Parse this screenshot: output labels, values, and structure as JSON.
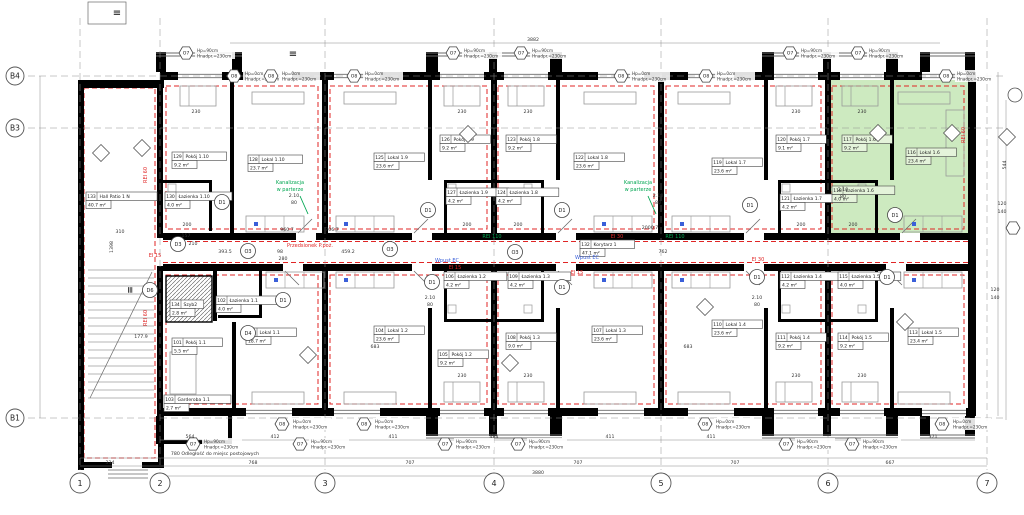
{
  "colors": {
    "wall": "#000000",
    "thin": "#6a6a6a",
    "red_line": "#e02525",
    "green_note": "#00a651",
    "blue_note": "#3a5fd9",
    "unit_highlight": "#cdeac0",
    "dim_text": "#333333",
    "grid": "#909090"
  },
  "grid": {
    "columns": [
      {
        "label": "1",
        "x": 80
      },
      {
        "label": "2",
        "x": 160
      },
      {
        "label": "3",
        "x": 325
      },
      {
        "label": "4",
        "x": 494
      },
      {
        "label": "5",
        "x": 661
      },
      {
        "label": "6",
        "x": 828
      },
      {
        "label": "7",
        "x": 987
      }
    ],
    "rows": [
      {
        "label": "B4",
        "y": 76
      },
      {
        "label": "B3",
        "y": 128
      },
      {
        "label": "B1",
        "y": 418
      }
    ]
  },
  "marker_legend": {
    "O7": [
      "Hp=90cm",
      "Hnadpr.=230cm"
    ],
    "O8": [
      "Hp=0cm",
      "Hnadpr.=230cm"
    ]
  },
  "window_markers": [
    {
      "type": "O7",
      "x": 186,
      "y": 53
    },
    {
      "type": "O7",
      "x": 453,
      "y": 53
    },
    {
      "type": "O7",
      "x": 521,
      "y": 53
    },
    {
      "type": "O7",
      "x": 790,
      "y": 53
    },
    {
      "type": "O7",
      "x": 858,
      "y": 53
    },
    {
      "type": "O8",
      "x": 234,
      "y": 76
    },
    {
      "type": "O8",
      "x": 271,
      "y": 76
    },
    {
      "type": "O8",
      "x": 354,
      "y": 76
    },
    {
      "type": "O8",
      "x": 621,
      "y": 76
    },
    {
      "type": "O8",
      "x": 706,
      "y": 76
    },
    {
      "type": "O8",
      "x": 946,
      "y": 76
    },
    {
      "type": "O8",
      "x": 282,
      "y": 424
    },
    {
      "type": "O8",
      "x": 364,
      "y": 424
    },
    {
      "type": "O8",
      "x": 705,
      "y": 424
    },
    {
      "type": "O8",
      "x": 942,
      "y": 424
    },
    {
      "type": "O7",
      "x": 193,
      "y": 444
    },
    {
      "type": "O7",
      "x": 300,
      "y": 444
    },
    {
      "type": "O7",
      "x": 445,
      "y": 444
    },
    {
      "type": "O7",
      "x": 518,
      "y": 444
    },
    {
      "type": "O7",
      "x": 786,
      "y": 444
    },
    {
      "type": "O7",
      "x": 852,
      "y": 444
    }
  ],
  "rooms": [
    {
      "num": "129",
      "name": "Pokój 1.10",
      "area": "9.2 m²",
      "x": 172,
      "y": 152
    },
    {
      "num": "128",
      "name": "Lokal 1.10",
      "area": "23.7 m²",
      "x": 248,
      "y": 155
    },
    {
      "num": "130",
      "name": "Łazienka 1.10",
      "area": "4.0 m²",
      "x": 165,
      "y": 192
    },
    {
      "num": "125",
      "name": "Lokal 1.9",
      "area": "23.6 m²",
      "x": 374,
      "y": 153
    },
    {
      "num": "126",
      "name": "Pokój 1.9",
      "area": "9.2 m²",
      "x": 440,
      "y": 135
    },
    {
      "num": "127",
      "name": "Łazienka 1.9",
      "area": "4.2 m²",
      "x": 446,
      "y": 188
    },
    {
      "num": "122",
      "name": "Lokal 1.8",
      "area": "23.6 m²",
      "x": 574,
      "y": 153
    },
    {
      "num": "123",
      "name": "Pokój 1.8",
      "area": "9.2 m²",
      "x": 506,
      "y": 135
    },
    {
      "num": "124",
      "name": "Łazienka 1.8",
      "area": "4.2 m²",
      "x": 496,
      "y": 188
    },
    {
      "num": "119",
      "name": "Lokal 1.7",
      "area": "23.6 m²",
      "x": 712,
      "y": 158
    },
    {
      "num": "120",
      "name": "Pokój 1.7",
      "area": "9.1 m²",
      "x": 776,
      "y": 135
    },
    {
      "num": "121",
      "name": "Łazienka 1.7",
      "area": "4.2 m²",
      "x": 780,
      "y": 194
    },
    {
      "num": "116",
      "name": "Lokal 1.6",
      "area": "23.4 m²",
      "x": 906,
      "y": 148,
      "green": true
    },
    {
      "num": "117",
      "name": "Pokój 1.6",
      "area": "9.2 m²",
      "x": 842,
      "y": 135,
      "green": true
    },
    {
      "num": "118",
      "name": "Łazienka 1.6",
      "area": "4.0 m²",
      "x": 832,
      "y": 186,
      "green": true
    },
    {
      "num": "133",
      "name": "Hall Patio 1 N",
      "area": "40.7 m²",
      "x": 86,
      "y": 192
    },
    {
      "num": "132",
      "name": "Korytarz 1",
      "area": "47.1 m²",
      "x": 580,
      "y": 240
    },
    {
      "num": "134",
      "name": "Szyb2",
      "area": "2.8 m²",
      "x": 170,
      "y": 300
    },
    {
      "num": "102",
      "name": "Łazienka 1.1",
      "area": "4.0 m²",
      "x": 216,
      "y": 296
    },
    {
      "num": "101",
      "name": "Pokój 1.1",
      "area": "5.5 m²",
      "x": 172,
      "y": 338
    },
    {
      "num": "100",
      "name": "Lokal 1.1",
      "area": "18.7 m²",
      "x": 246,
      "y": 328
    },
    {
      "num": "103",
      "name": "Garderoba 1.1",
      "area": "2.7 m²",
      "x": 164,
      "y": 395
    },
    {
      "num": "104",
      "name": "Lokal 1.2",
      "area": "23.6 m²",
      "x": 374,
      "y": 326
    },
    {
      "num": "105",
      "name": "Pokój 1.2",
      "area": "9.2 m²",
      "x": 438,
      "y": 350
    },
    {
      "num": "106",
      "name": "Łazienka 1.2",
      "area": "4.2 m²",
      "x": 444,
      "y": 272
    },
    {
      "num": "107",
      "name": "Lokal 1.3",
      "area": "23.6 m²",
      "x": 592,
      "y": 326
    },
    {
      "num": "108",
      "name": "Pokój 1.3",
      "area": "9.0 m²",
      "x": 506,
      "y": 333
    },
    {
      "num": "109",
      "name": "Łazienka 1.3",
      "area": "4.2 m²",
      "x": 508,
      "y": 272
    },
    {
      "num": "110",
      "name": "Lokal 1.4",
      "area": "23.6 m²",
      "x": 712,
      "y": 320
    },
    {
      "num": "111",
      "name": "Pokój 1.4",
      "area": "9.2 m²",
      "x": 776,
      "y": 333
    },
    {
      "num": "112",
      "name": "Łazienka 1.4",
      "area": "4.2 m²",
      "x": 780,
      "y": 272
    },
    {
      "num": "113",
      "name": "Lokal 1.5",
      "area": "23.4 m²",
      "x": 908,
      "y": 328
    },
    {
      "num": "114",
      "name": "Pokój 1.5",
      "area": "9.2 m²",
      "x": 838,
      "y": 333
    },
    {
      "num": "115",
      "name": "Łazienka 1.5",
      "area": "4.0 m²",
      "x": 838,
      "y": 272
    }
  ],
  "door_markers": [
    {
      "label": "D1",
      "x": 222,
      "y": 202
    },
    {
      "label": "D1",
      "x": 428,
      "y": 210
    },
    {
      "label": "D1",
      "x": 562,
      "y": 210
    },
    {
      "label": "D1",
      "x": 750,
      "y": 205
    },
    {
      "label": "D1",
      "x": 895,
      "y": 215
    },
    {
      "label": "D1",
      "x": 283,
      "y": 300
    },
    {
      "label": "D1",
      "x": 432,
      "y": 282
    },
    {
      "label": "D1",
      "x": 562,
      "y": 287
    },
    {
      "label": "D1",
      "x": 757,
      "y": 277
    },
    {
      "label": "D1",
      "x": 887,
      "y": 277
    },
    {
      "label": "D4",
      "x": 248,
      "y": 333
    },
    {
      "label": "D6",
      "x": 150,
      "y": 290
    },
    {
      "label": "D3",
      "x": 178,
      "y": 244
    },
    {
      "label": "O3",
      "x": 248,
      "y": 251
    },
    {
      "label": "O3",
      "x": 515,
      "y": 252
    },
    {
      "label": "O3",
      "x": 390,
      "y": 249
    }
  ],
  "diamonds": [
    {
      "x": 101,
      "y": 153
    },
    {
      "x": 142,
      "y": 148
    },
    {
      "x": 468,
      "y": 134
    },
    {
      "x": 878,
      "y": 133
    },
    {
      "x": 952,
      "y": 133
    },
    {
      "x": 510,
      "y": 363
    },
    {
      "x": 705,
      "y": 307
    },
    {
      "x": 905,
      "y": 322
    },
    {
      "x": 308,
      "y": 355
    },
    {
      "x": 1007,
      "y": 137
    }
  ],
  "dimensions": [
    {
      "x": 110,
      "y": 464,
      "t": "334"
    },
    {
      "x": 253,
      "y": 464,
      "t": "768"
    },
    {
      "x": 410,
      "y": 464,
      "t": "707"
    },
    {
      "x": 578,
      "y": 464,
      "t": "707"
    },
    {
      "x": 735,
      "y": 464,
      "t": "707"
    },
    {
      "x": 890,
      "y": 464,
      "t": "667"
    },
    {
      "x": 215,
      "y": 455,
      "t": "780  Odległość do miejsc postojowych"
    },
    {
      "x": 538,
      "y": 474,
      "t": "3880"
    },
    {
      "x": 533,
      "y": 41,
      "t": "3882"
    },
    {
      "x": 190,
      "y": 438,
      "t": "564"
    },
    {
      "x": 275,
      "y": 438,
      "t": "412"
    },
    {
      "x": 393,
      "y": 438,
      "t": "411"
    },
    {
      "x": 494,
      "y": 438,
      "t": "484"
    },
    {
      "x": 610,
      "y": 438,
      "t": "411"
    },
    {
      "x": 711,
      "y": 438,
      "t": "411"
    },
    {
      "x": 933,
      "y": 438,
      "t": "371"
    },
    {
      "x": 287,
      "y": 231,
      "t": "960.7"
    },
    {
      "x": 332,
      "y": 231,
      "t": "706.7"
    },
    {
      "x": 650,
      "y": 229,
      "t": "2000.7"
    },
    {
      "x": 663,
      "y": 253,
      "t": "762"
    },
    {
      "x": 225,
      "y": 253,
      "t": "393.5"
    },
    {
      "x": 280,
      "y": 253,
      "t": "98"
    },
    {
      "x": 283,
      "y": 260,
      "t": "280"
    },
    {
      "x": 348,
      "y": 253,
      "t": "459.2"
    },
    {
      "x": 186,
      "y": 237,
      "t": "157"
    },
    {
      "x": 193,
      "y": 245,
      "t": "210"
    },
    {
      "x": 196,
      "y": 113,
      "t": "230"
    },
    {
      "x": 462,
      "y": 113,
      "t": "230"
    },
    {
      "x": 528,
      "y": 113,
      "t": "230"
    },
    {
      "x": 796,
      "y": 113,
      "t": "230"
    },
    {
      "x": 862,
      "y": 113,
      "t": "230"
    },
    {
      "x": 462,
      "y": 377,
      "t": "230"
    },
    {
      "x": 528,
      "y": 377,
      "t": "230"
    },
    {
      "x": 796,
      "y": 377,
      "t": "230"
    },
    {
      "x": 862,
      "y": 377,
      "t": "230"
    },
    {
      "x": 187,
      "y": 226,
      "t": "200"
    },
    {
      "x": 467,
      "y": 226,
      "t": "200"
    },
    {
      "x": 518,
      "y": 226,
      "t": "200"
    },
    {
      "x": 801,
      "y": 226,
      "t": "200"
    },
    {
      "x": 853,
      "y": 226,
      "t": "200"
    },
    {
      "x": 375,
      "y": 348,
      "t": "683"
    },
    {
      "x": 688,
      "y": 348,
      "t": "683"
    },
    {
      "x": 294,
      "y": 197,
      "t": "2.10"
    },
    {
      "x": 294,
      "y": 204,
      "t": "80"
    },
    {
      "x": 658,
      "y": 197,
      "t": "2.10"
    },
    {
      "x": 658,
      "y": 204,
      "t": "80"
    },
    {
      "x": 843,
      "y": 191,
      "t": "2.10"
    },
    {
      "x": 843,
      "y": 198,
      "t": "80"
    },
    {
      "x": 430,
      "y": 299,
      "t": "2.10"
    },
    {
      "x": 430,
      "y": 306,
      "t": "80"
    },
    {
      "x": 757,
      "y": 299,
      "t": "2.10"
    },
    {
      "x": 757,
      "y": 306,
      "t": "80"
    },
    {
      "x": 1002,
      "y": 205,
      "t": "120"
    },
    {
      "x": 1002,
      "y": 213,
      "t": "140"
    },
    {
      "x": 995,
      "y": 291,
      "t": "120"
    },
    {
      "x": 995,
      "y": 299,
      "t": "140"
    },
    {
      "x": 1006,
      "y": 165,
      "t": "544",
      "r": -90
    },
    {
      "x": 113,
      "y": 247,
      "t": "1398",
      "r": -90
    },
    {
      "x": 120,
      "y": 233,
      "t": "310"
    },
    {
      "x": 141,
      "y": 338,
      "t": "177.9"
    }
  ],
  "annotations": [
    {
      "x": 310,
      "y": 247,
      "t": "Przedsionek P.poż.",
      "c": "red"
    },
    {
      "x": 617,
      "y": 238,
      "t": "EI 30",
      "c": "red"
    },
    {
      "x": 758,
      "y": 261,
      "t": "EI 30",
      "c": "red"
    },
    {
      "x": 155,
      "y": 257,
      "t": "EI 15",
      "c": "red"
    },
    {
      "x": 455,
      "y": 269,
      "t": "EI 15",
      "c": "red"
    },
    {
      "x": 577,
      "y": 274,
      "t": "EI 15",
      "c": "red"
    },
    {
      "x": 147,
      "y": 175,
      "t": "REI 60",
      "c": "red",
      "r": -90
    },
    {
      "x": 147,
      "y": 318,
      "t": "REI 60",
      "c": "red",
      "r": -90
    },
    {
      "x": 965,
      "y": 135,
      "t": "REI 60",
      "c": "red",
      "r": -90
    },
    {
      "x": 290,
      "y": 184,
      "t": "Kanalizacja",
      "c": "green"
    },
    {
      "x": 290,
      "y": 191,
      "t": "w parterze",
      "c": "green"
    },
    {
      "x": 638,
      "y": 184,
      "t": "Kanalizacja",
      "c": "green"
    },
    {
      "x": 638,
      "y": 191,
      "t": "w parterze",
      "c": "green"
    },
    {
      "x": 492,
      "y": 238,
      "t": "REI 110",
      "c": "green"
    },
    {
      "x": 675,
      "y": 238,
      "t": "REI 110",
      "c": "green"
    },
    {
      "x": 447,
      "y": 262,
      "t": "Wpust EC",
      "c": "blue"
    },
    {
      "x": 587,
      "y": 259,
      "t": "Wpust EC",
      "c": "blue"
    },
    {
      "x": 117,
      "y": 16,
      "t": "≡",
      "c": "black",
      "s": 10
    },
    {
      "x": 293,
      "y": 57,
      "t": "≡",
      "c": "black",
      "s": 10
    },
    {
      "x": 133,
      "y": 290,
      "t": "≡",
      "c": "black",
      "s": 9,
      "r": -90
    }
  ]
}
